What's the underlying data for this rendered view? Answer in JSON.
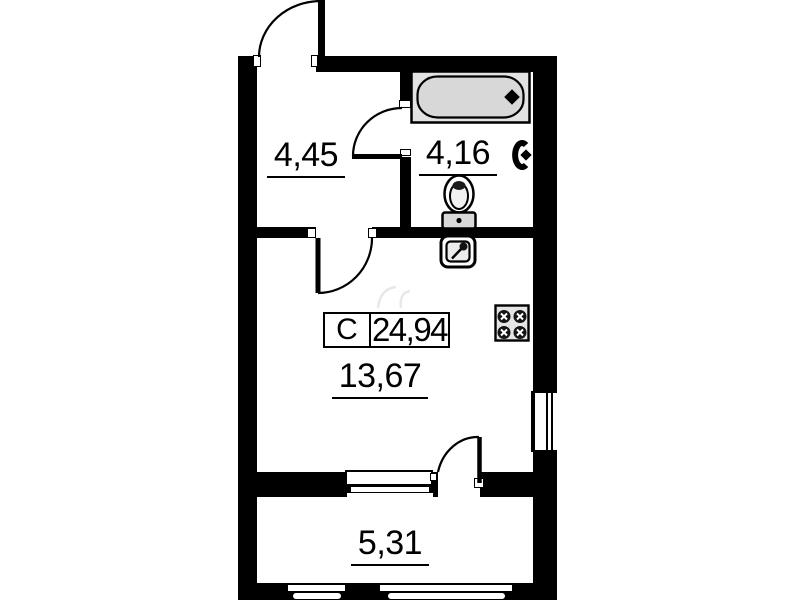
{
  "floorplan": {
    "unit_type_label": "С",
    "total_area": "24,94",
    "rooms": {
      "hall_area": "4,45",
      "bathroom_area": "4,16",
      "living_area": "13,67",
      "balcony_area": "5,31"
    },
    "fixtures": [
      "bathtub",
      "towel-dryer",
      "toilet",
      "kitchen-sink",
      "stove"
    ],
    "colors": {
      "wall": "#000000",
      "fixture_fill": "#dcdcdc",
      "background": "#ffffff"
    }
  }
}
